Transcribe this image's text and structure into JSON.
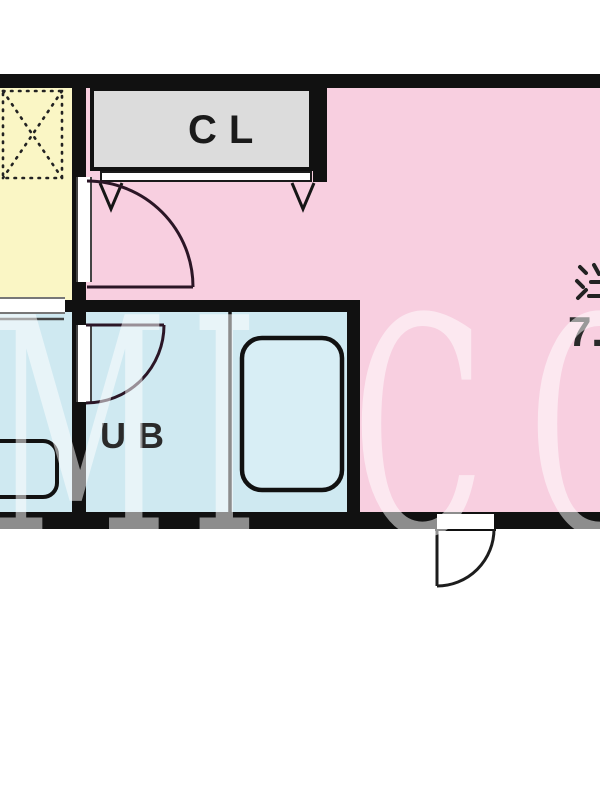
{
  "floorplan": {
    "closet_label": "CL",
    "unit_bath_label": "UB",
    "main_room_label_partial": "洋",
    "main_room_size_partial": "7.",
    "features": [
      "closet-with-folding-doors",
      "appliance-space-dashed-box",
      "unit-bath-with-tub",
      "kitchen-counter-strip",
      "entrance-door-swing",
      "room-door-swings"
    ]
  },
  "watermark": {
    "text": "MICO",
    "letters": [
      {
        "char": "M"
      },
      {
        "char": "I"
      },
      {
        "char": "C"
      },
      {
        "char": "O"
      }
    ]
  },
  "colors": {
    "wall": "#111111",
    "room_pink": "#f8cfe0",
    "room_yellow": "#faf6c5",
    "room_blue": "#cfe9f1",
    "closet_gray": "#dcdcdc",
    "background": "#ffffff",
    "watermark": "rgba(255,255,255,0.52)"
  }
}
